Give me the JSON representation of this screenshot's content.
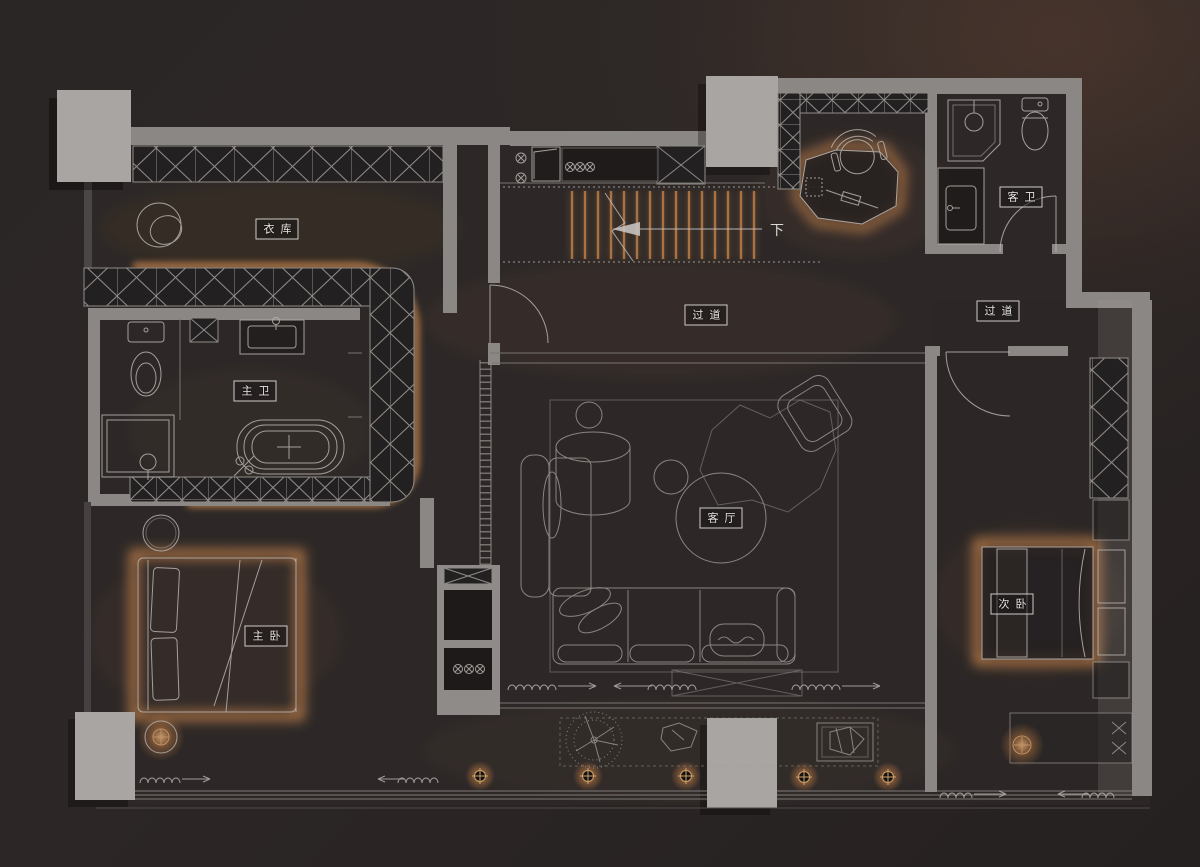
{
  "document_type": "residential floor plan (dark render)",
  "rooms": {
    "cloakroom": "衣库",
    "master_bath": "主卫",
    "master_bedroom": "主卧",
    "corridor_center": "过道",
    "corridor_east": "过道",
    "living_room": "客厅",
    "secondary_bedroom": "次卧",
    "guest_bath": "客卫"
  },
  "annotations": {
    "stairs_down": "下"
  },
  "colors": {
    "background": "#2a2525",
    "wall_gray": "#8b8785",
    "column_gray": "#a8a5a2",
    "line_light": "#b8b4b1",
    "hatch_fill": "#232021",
    "accent_glow": "#c9854d",
    "label_text": "#e8e4e1"
  }
}
